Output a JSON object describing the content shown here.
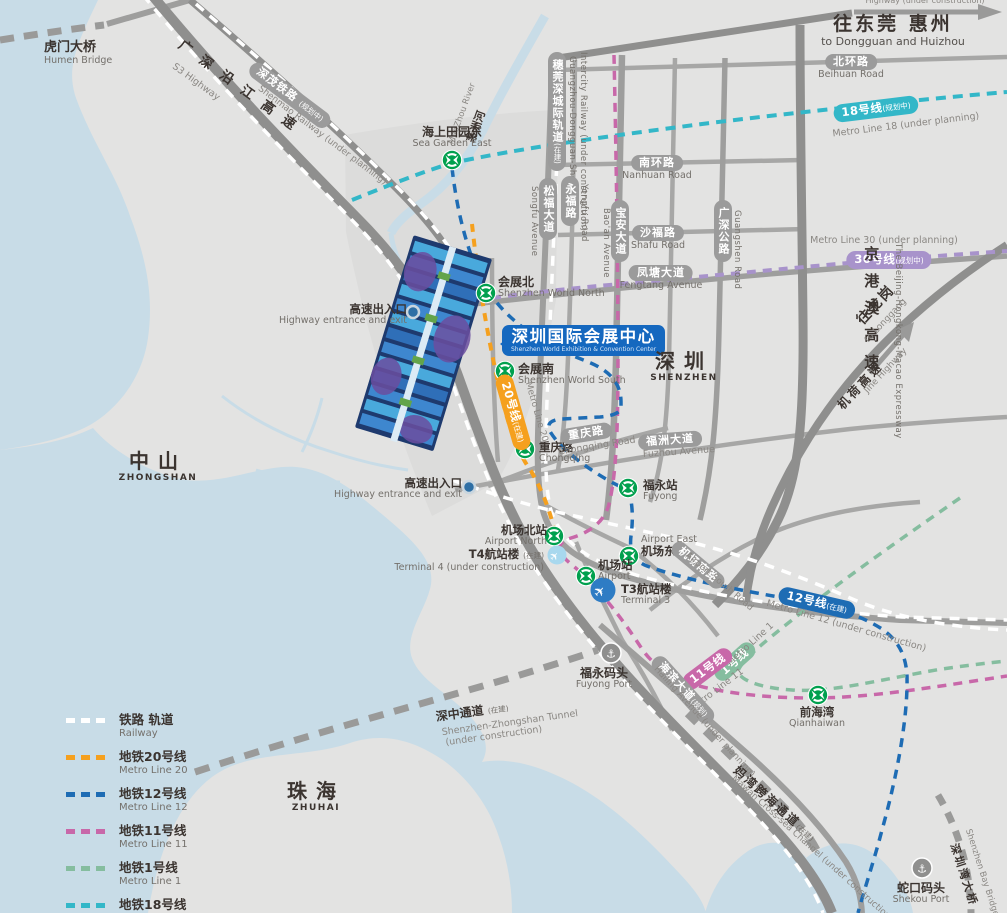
{
  "colors": {
    "line20": "#F5A01E",
    "line12": "#1E6CB4",
    "line11": "#C868A9",
    "line1": "#85BD9F",
    "line18": "#33B7C8",
    "line30": "#A893CB",
    "railway": "#FFFFFF",
    "road_pill": "#9B9B9B",
    "title_bg": "#1568BF",
    "water": "#C8DCE7",
    "land": "#E3E3E2",
    "station_green": "#00A04E",
    "terminal_blue": "#2E7CC4",
    "terminal_light": "#A8D8EE"
  },
  "icons": {
    "anchor": "⚓",
    "plane": "✈"
  },
  "title": {
    "zh": "深圳国际会展中心",
    "en": "Shenzhen World Exhibition & Convention Center"
  },
  "regions": {
    "shenzhen": {
      "zh": "深圳",
      "en": "SHENZHEN"
    },
    "zhongshan": {
      "zh": "中山",
      "en": "ZHONGSHAN"
    },
    "zhuhai": {
      "zh": "珠海",
      "en": "ZHUHAI"
    }
  },
  "directions": {
    "dongguan": {
      "zh": "往东莞 惠州",
      "en": "to Dongguan and Huizhou"
    },
    "longgang": {
      "zh": "往龙岗",
      "en": "to Longgang"
    },
    "top_note": "Highway (under construction)"
  },
  "stations": {
    "sea_garden": {
      "zh": "海上田园东",
      "en": "Sea Garden East"
    },
    "world_north": {
      "zh": "会展北",
      "en": "Shenzhen World North"
    },
    "world_south": {
      "zh": "会展南",
      "en": "Shenzhen World South"
    },
    "chongqing": {
      "zh": "重庆路",
      "en": "Chongqing"
    },
    "fuyong": {
      "zh": "福永站",
      "en": "Fuyong"
    },
    "airport_north": {
      "zh": "机场北站",
      "en": "Airport North"
    },
    "airport_east": {
      "zh": "机场东站",
      "en": "Airport East"
    },
    "airport": {
      "zh": "机场站",
      "en": "Airport"
    },
    "qianhaiwan": {
      "zh": "前海湾",
      "en": "Qianhaiwan"
    }
  },
  "ports": {
    "fuyong_port": {
      "zh": "福永码头",
      "en": "Fuyong Port"
    },
    "shekou_port": {
      "zh": "蛇口码头",
      "en": "Shekou Port"
    }
  },
  "terminals": {
    "t4": {
      "zh": "T4航站楼",
      "note": "(在建)",
      "en": "Terminal 4 (under construction)"
    },
    "t3": {
      "zh": "T3航站楼",
      "en": "Terminal 3"
    }
  },
  "entrance": {
    "zh": "高速出入口",
    "en": "Highway entrance and exit"
  },
  "roads": {
    "beihuan": {
      "zh": "北环路",
      "en": "Beihuan Road"
    },
    "nanhuan": {
      "zh": "南环路",
      "en": "Nanhuan Road"
    },
    "shalu": {
      "zh": "沙福路",
      "en": "Shafu Road"
    },
    "fengtang": {
      "zh": "凤塘大道",
      "en": "Fengtang Avenue"
    },
    "fuzhou": {
      "zh": "福洲大道",
      "en": "Fuzhou Avenue"
    },
    "chongqing_rd": {
      "zh": "重庆路",
      "en": "Chongqing Road"
    },
    "songfu": {
      "zh": "松福大道",
      "en": "Songfu Avenue"
    },
    "yongfu": {
      "zh": "永福路",
      "en": "Yongfu Road"
    },
    "baoan": {
      "zh": "宝安大道",
      "en": "Bao'an Avenue"
    },
    "guangshen": {
      "zh": "广深公路",
      "en": "Guangshen Road"
    },
    "airport_south": {
      "zh": "机场南路",
      "en": "Airport South Road"
    },
    "haibin": {
      "zh": "海滨大道",
      "note": "(规划)",
      "en": "Hailing Avenue (under planning)"
    },
    "s3": {
      "zh": "广深沿江高速",
      "en": "S3 Highway"
    },
    "jinggangao": {
      "zh": "京港澳高速",
      "en": "The Beijing-Hongkong-Macao Expressway"
    },
    "jihe": {
      "zh": "机荷高速",
      "en": "Jihe Highway"
    }
  },
  "crossings": {
    "humen": {
      "zh": "虎门大桥",
      "en": "Humen Bridge"
    },
    "shenzhong": {
      "zh": "深中通道",
      "note": "(在建)",
      "en1": "Shenzhen-Zhongshan Tunnel",
      "en2": "(under construction)"
    },
    "mawan": {
      "zh": "妈湾跨海通道",
      "note": "(在建)",
      "en": "Mawan Cross-sea Channel (under construction)"
    },
    "szbay": {
      "zh": "深圳湾大桥",
      "en": "Shenzhen Bay Bridge"
    }
  },
  "railways": {
    "shenmao": {
      "zh": "深茂铁路",
      "note": "(规划中)",
      "en": "Shenmao Railway (under planning)"
    },
    "suiwanshen": {
      "zh": "穗莞深城际轨道",
      "note": "(在建)",
      "en1": "Guangzhou-Dongguan-Shenzhen",
      "en2": "Intercity Railway (under construction)"
    }
  },
  "river": {
    "zh": "茅洲河",
    "en": "MaoZhou River"
  },
  "metro_pills": {
    "line18": {
      "num": "18号线",
      "note": "(规划中)",
      "en": "Metro Line 18 (under planning)"
    },
    "line30": {
      "num": "30号线",
      "note": "(规划中)",
      "en": "Metro Line 30 (under planning)"
    },
    "line12": {
      "num": "12号线",
      "note": "(在建)",
      "en": "Metro Line 12 (under construction)"
    },
    "line11": {
      "num": "11号线",
      "en": "Metro Line 11"
    },
    "line1": {
      "num": "1号线",
      "en": "Metro Line 1"
    },
    "line20": {
      "num": "20号线",
      "note": "(在建)",
      "en": "Metro Line 20"
    }
  },
  "legend": {
    "items": [
      {
        "zh": "铁路 轨道",
        "en": "Railway",
        "color": "#FFFFFF"
      },
      {
        "zh": "地铁20号线",
        "en": "Metro Line 20",
        "color": "#F5A01E"
      },
      {
        "zh": "地铁12号线",
        "en": "Metro Line 12",
        "color": "#1E6CB4"
      },
      {
        "zh": "地铁11号线",
        "en": "Metro Line 11",
        "color": "#C868A9"
      },
      {
        "zh": "地铁1号线",
        "en": "Metro Line 1",
        "color": "#85BD9F"
      },
      {
        "zh": "地铁18号线",
        "en": "Metro Line 18",
        "color": "#33B7C8"
      }
    ]
  }
}
